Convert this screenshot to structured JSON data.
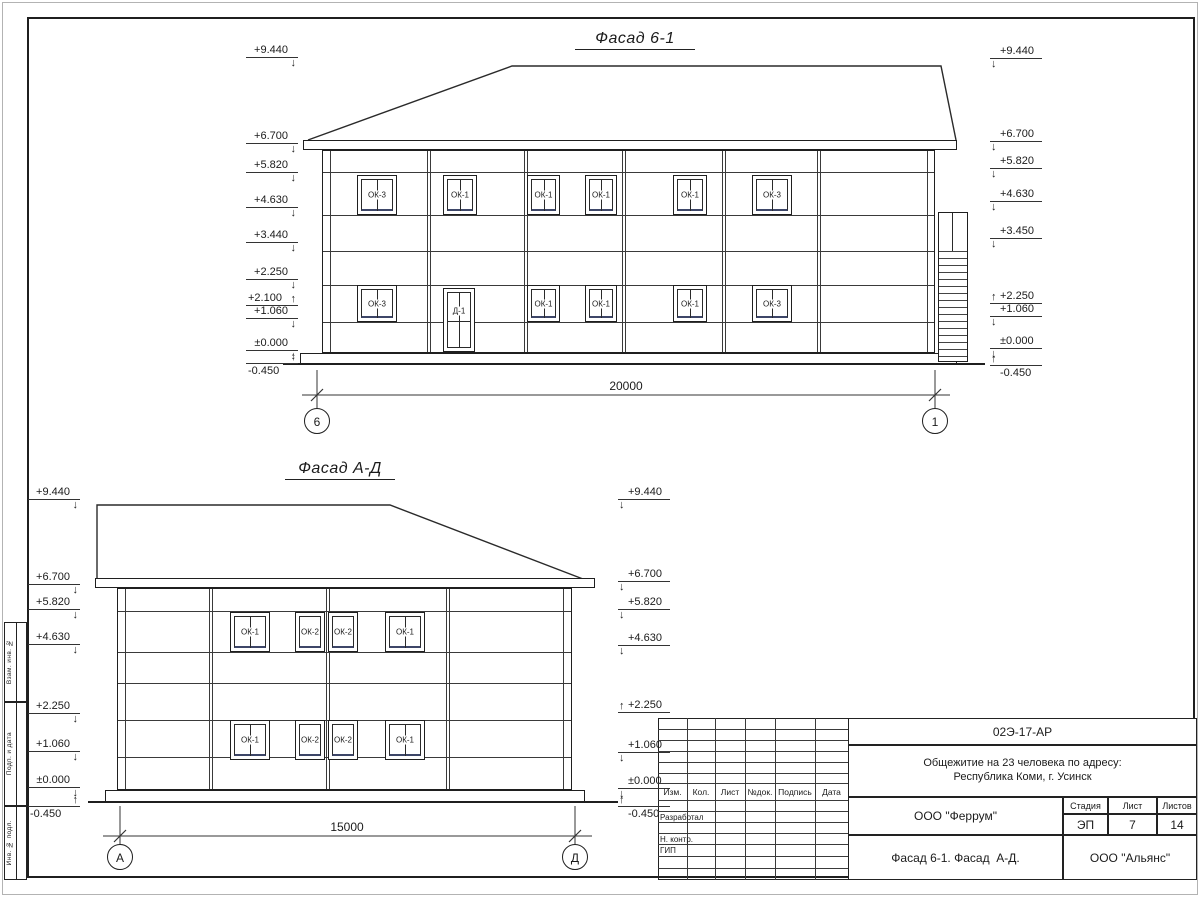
{
  "sheet": {
    "facades": [
      {
        "title": "Фасад 6-1",
        "elevations_left": [
          "+9.440",
          "+6.700",
          "+5.820",
          "+4.630",
          "+3.440",
          "+2.250",
          "+2.100",
          "+1.060",
          "±0.000",
          "-0.450"
        ],
        "elevations_right": [
          "+9.440",
          "+6.700",
          "+5.820",
          "+4.630",
          "+3.450",
          "+2.250",
          "+1.060",
          "±0.000",
          "-0.450"
        ],
        "windows_upper": [
          "ОК-3",
          "ОК-1",
          "ОК-1",
          "ОК-1",
          "ОК-1",
          "ОК-3"
        ],
        "windows_lower": [
          "ОК-3",
          "Д-1",
          "ОК-1",
          "ОК-1",
          "ОК-1",
          "ОК-3"
        ],
        "dimension": "20000",
        "axis_start": "6",
        "axis_end": "1"
      },
      {
        "title": "Фасад А-Д",
        "elevations_left": [
          "+9.440",
          "+6.700",
          "+5.820",
          "+4.630",
          "+2.250",
          "+1.060",
          "±0.000",
          "-0.450"
        ],
        "elevations_right": [
          "+9.440",
          "+6.700",
          "+5.820",
          "+4.630",
          "+2.250",
          "+1.060",
          "±0.000",
          "-0.450"
        ],
        "windows_upper": [
          "ОК-1",
          "ОК-2",
          "ОК-2",
          "ОК-1"
        ],
        "windows_lower": [
          "ОК-1",
          "ОК-2",
          "ОК-2",
          "ОК-1"
        ],
        "dimension": "15000",
        "axis_start": "А",
        "axis_end": "Д"
      }
    ],
    "side_stamp": [
      "Взам. инв. №",
      "Подп. и дата",
      "Инв. № подл."
    ],
    "title_block": {
      "doc_number": "02Э-17-АР",
      "project_line1": "Общежитие на 23 человека по адресу:",
      "project_line2": "Республика Коми, г. Усинск",
      "columns": [
        "Изм.",
        "Кол.",
        "Лист",
        "№док.",
        "Подпись",
        "Дата"
      ],
      "roles": [
        "Разработал",
        "Н. контр.",
        "ГИП"
      ],
      "org": "ООО \"Феррум\"",
      "stage_label": "Стадия",
      "stage": "ЭП",
      "sheet_label": "Лист",
      "sheet_no": "7",
      "sheets_label": "Листов",
      "sheets_total": "14",
      "sheet_title": "Фасад 6-1. Фасад  А-Д.",
      "org2": "ООО \"Альянс\""
    }
  }
}
